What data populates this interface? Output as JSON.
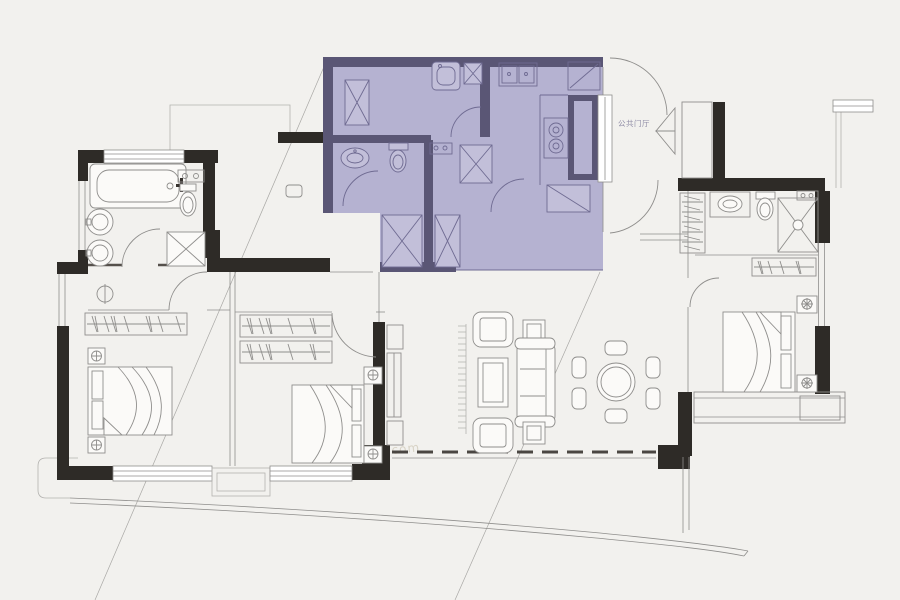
{
  "colors": {
    "background": "#f2f1ee",
    "wall": "#2e2b27",
    "line": "#8f8e8c",
    "line_light": "#b3b2af",
    "highlight_fill": "#b5b2d1",
    "highlight_wall": "#5a5675",
    "highlight_line": "#6f6b92",
    "highlight_fixture_fill": "#c2bfd9",
    "fixture_fill": "#fbfaf8",
    "label_text": "#8f8ca6",
    "watermark": "#d8d3c6"
  },
  "labels": {
    "foyer": "公共门厅"
  },
  "watermarks": {
    "w1": "房天下Fang.com",
    "w2": "房天下Fang.com",
    "w3": "Fang.com"
  }
}
